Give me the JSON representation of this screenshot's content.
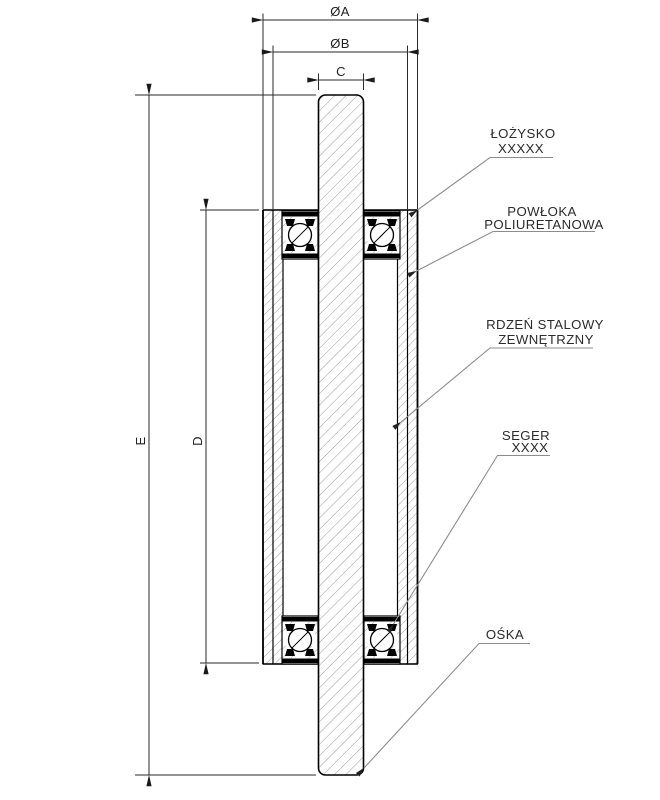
{
  "drawing": {
    "dimensions": {
      "oa": "ØA",
      "ob": "ØB",
      "c": "C",
      "d": "D",
      "e": "E"
    },
    "callouts": {
      "bearing": {
        "line1": "ŁOŻYSKO",
        "line2": "XXXXX"
      },
      "coating": {
        "line1": "POWŁOKA",
        "line2": "POLIURETANOWA"
      },
      "core": {
        "line1": "RDZEŃ STALOWY",
        "line2": "ZEWNĘTRZNY"
      },
      "seger": {
        "line1": "SEGER",
        "line2": "XXXX"
      },
      "axle": {
        "line1": "OŚKA"
      }
    },
    "colors": {
      "background": "#ffffff",
      "outline": "#000000",
      "hatch": "#909090",
      "leader": "#8c8c8c",
      "dimension_line": "#2a2a2a",
      "text": "#2b2b2b"
    }
  }
}
